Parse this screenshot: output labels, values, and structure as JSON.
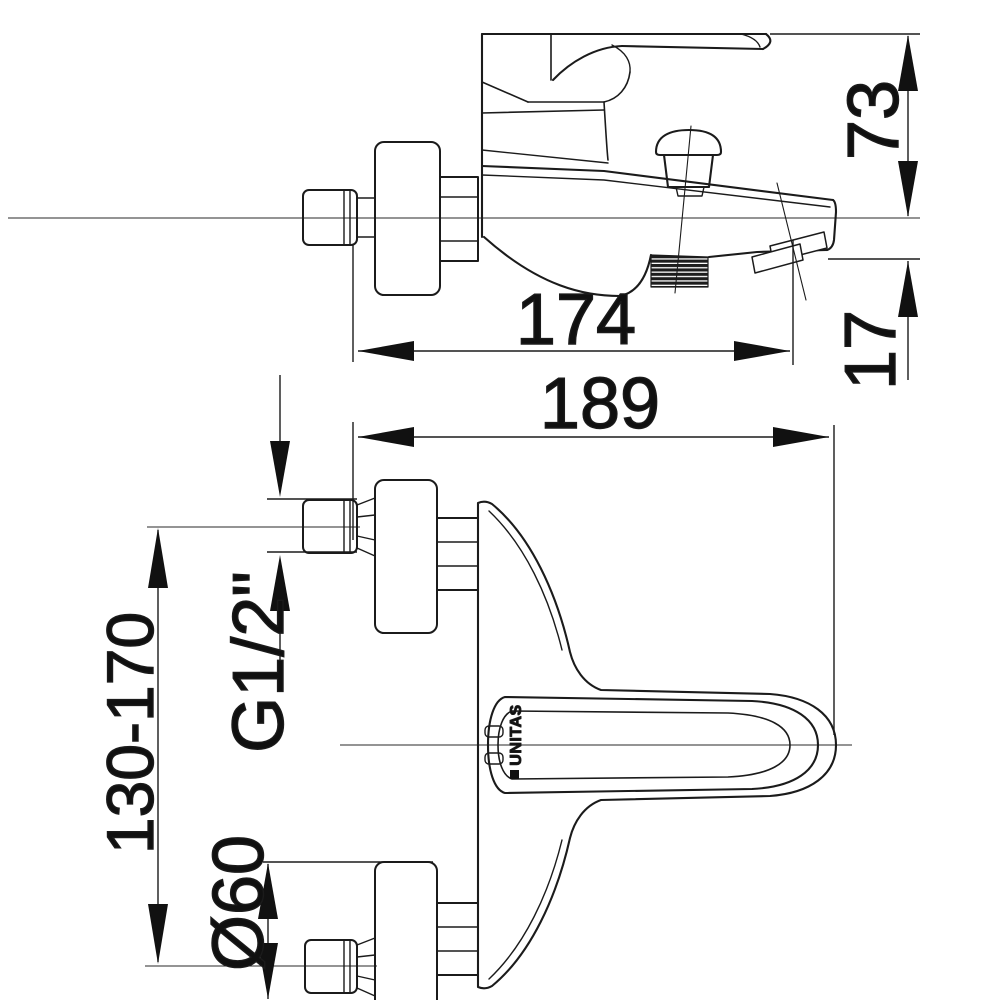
{
  "drawing": {
    "subject": "wall-mounted bath mixer tap technical drawing, side view and plan view",
    "brand": "UNITAS",
    "colors": {
      "background": "#ffffff",
      "line": "#1b1b1b",
      "text": "#101010"
    },
    "dimensions": {
      "lever_top_to_axis": "73",
      "axis_to_spout_outlet": "17",
      "wall_to_spout_tip": "174",
      "wall_to_handle_end": "189",
      "connection_thread": "G1/2\"",
      "mounting_height_range": "130-170",
      "escutcheon_diameter": "Ø60"
    }
  }
}
